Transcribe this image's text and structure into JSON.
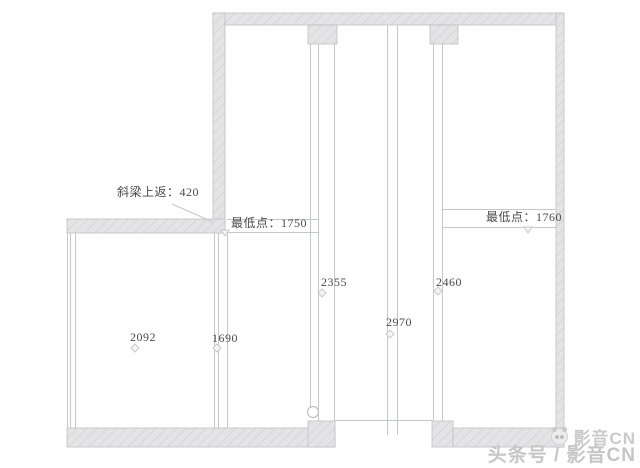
{
  "plan": {
    "annotations": {
      "beam_note": "斜梁上返：420",
      "lowest_left": "最低点：1750",
      "lowest_right": "最低点：1760"
    },
    "dimensions": {
      "d2092": "2092",
      "d1690": "1690",
      "d2355": "2355",
      "d2970": "2970",
      "d2460": "2460"
    }
  },
  "watermark": {
    "brand": "影音CN",
    "byline": "头条号 / 影音CN"
  },
  "colors": {
    "wall_fill": "#e4e4e6",
    "wall_hatch": "#d3d3d6",
    "wall_stroke": "#c0c0c3",
    "thin_line": "#c5c8ca",
    "text": "#4a4a4a",
    "watermark_text": "#c9c9c9"
  }
}
